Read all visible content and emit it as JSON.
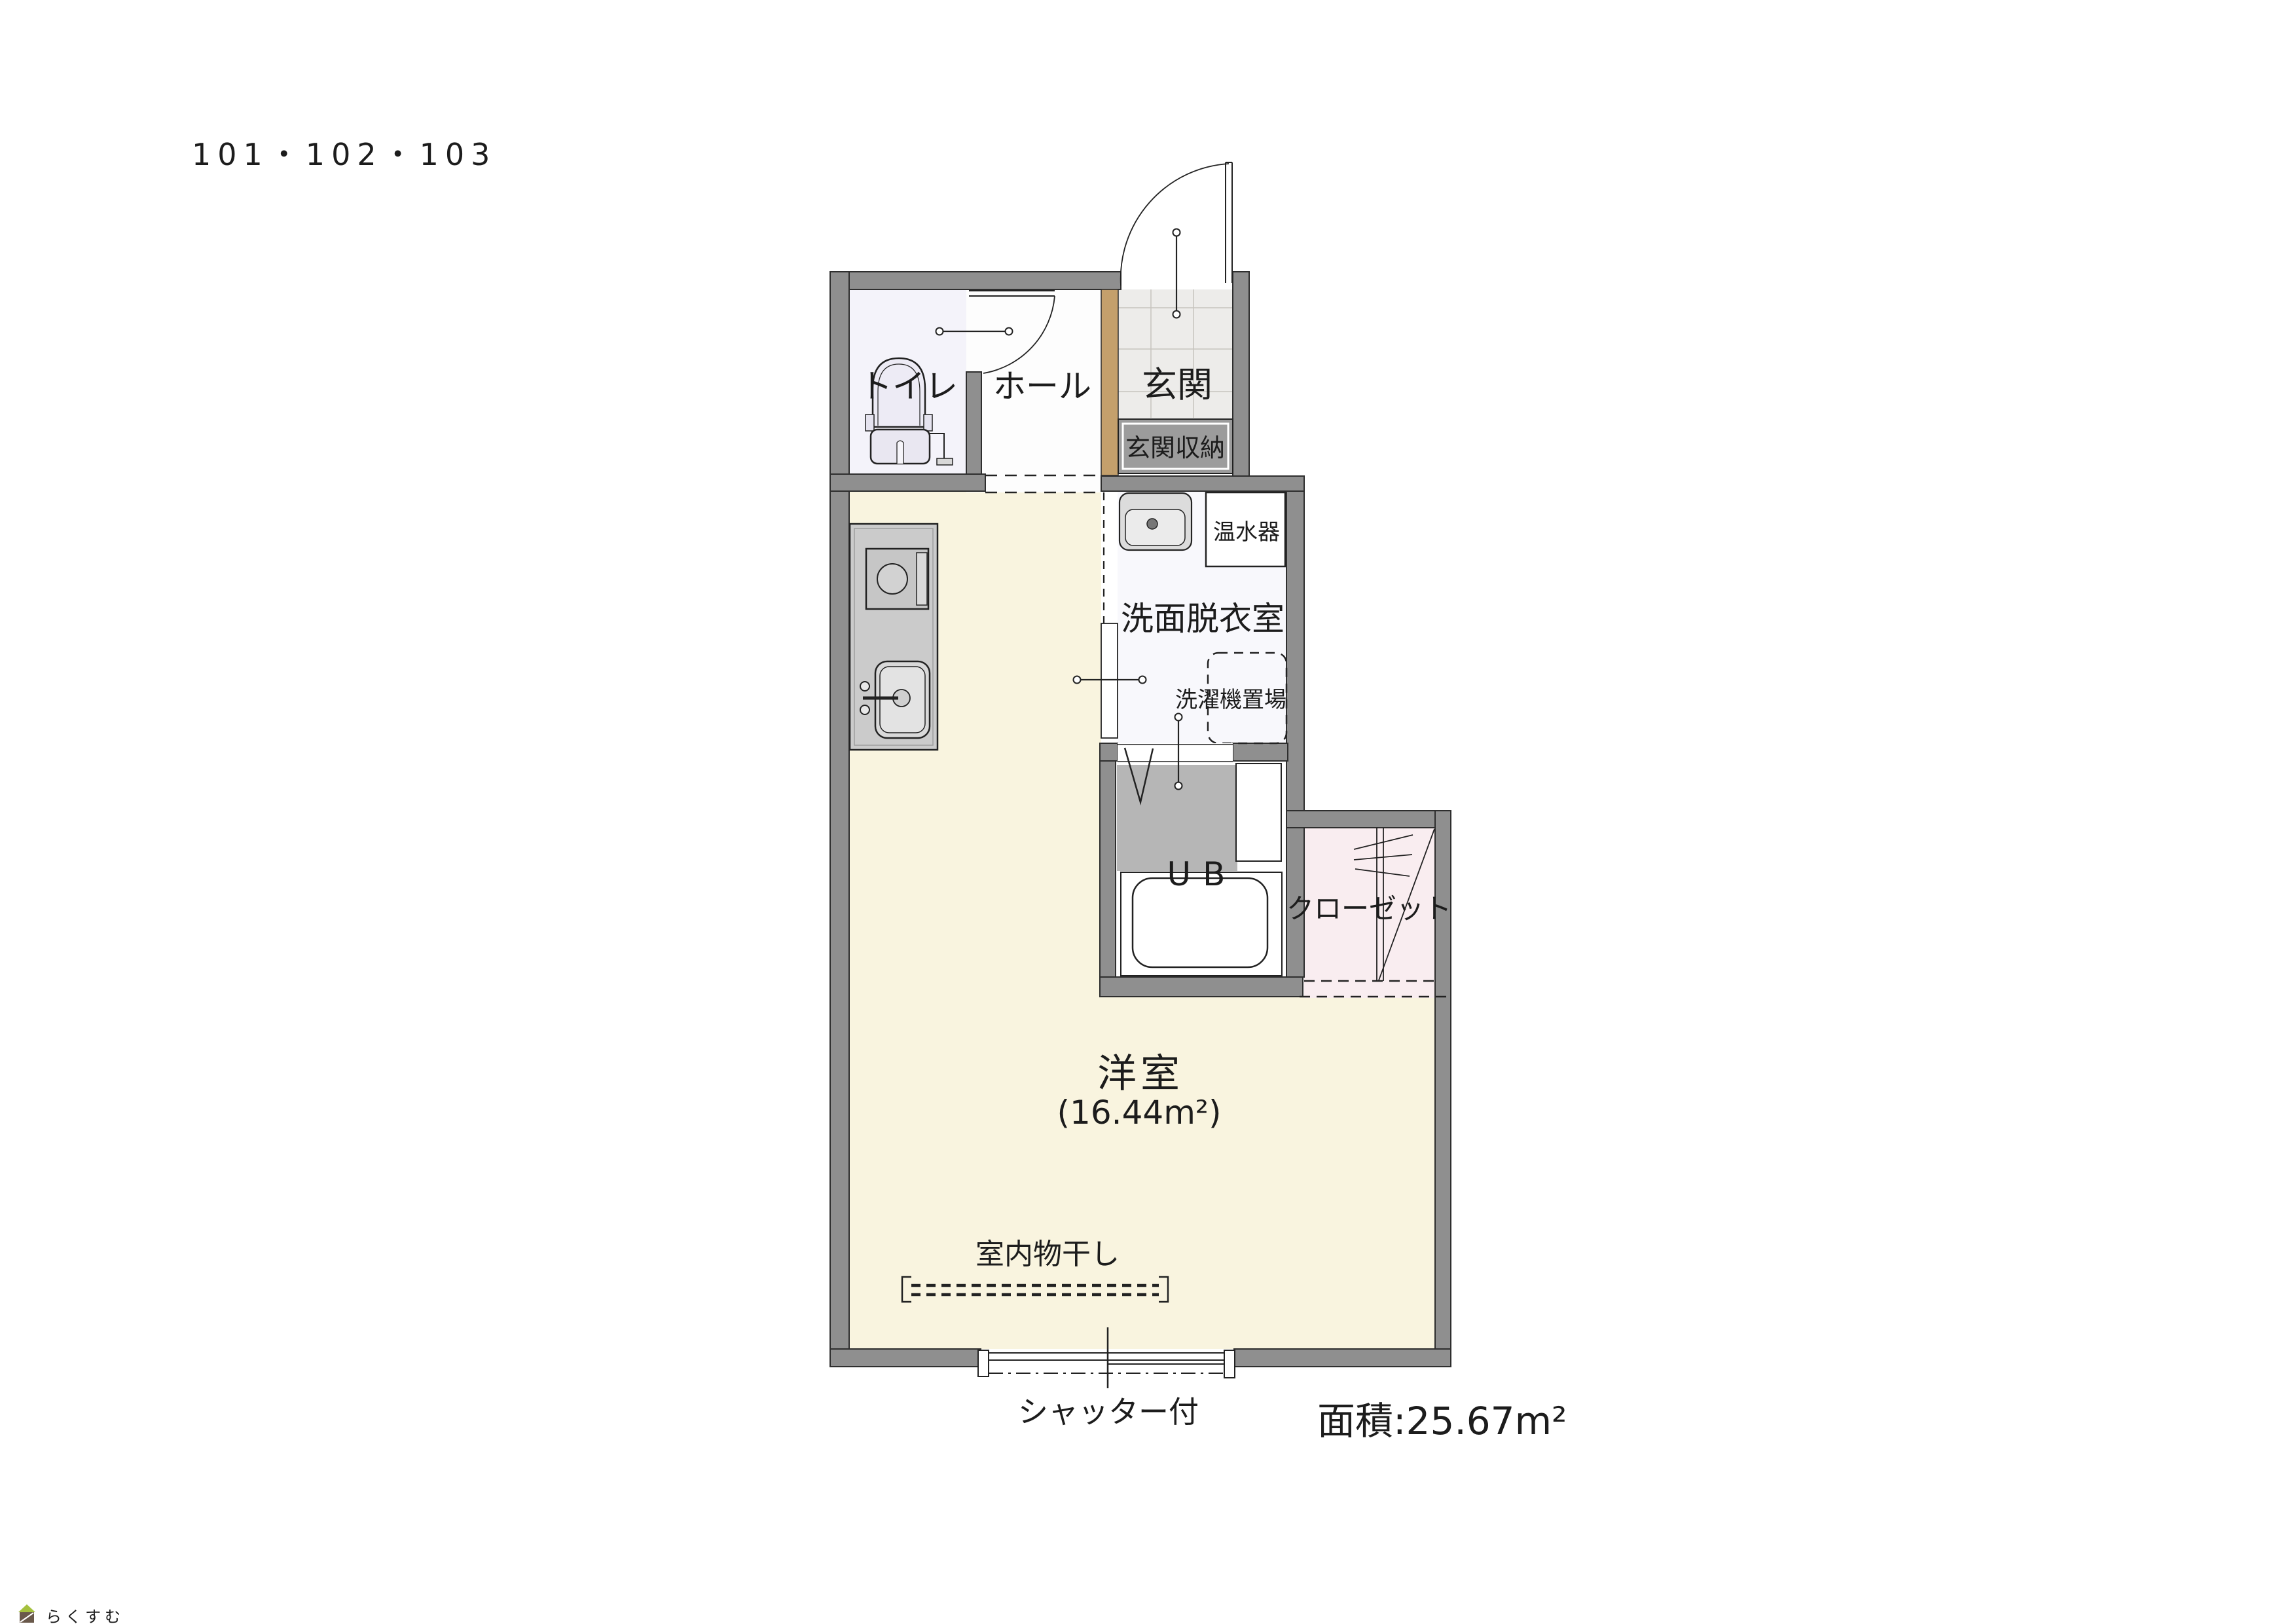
{
  "title": "101・102・103",
  "plan": {
    "rooms": {
      "toilet": {
        "label": "トイレ"
      },
      "hall": {
        "label": "ホール"
      },
      "entrance": {
        "label": "玄関"
      },
      "entrance_storage": {
        "label": "玄関収納"
      },
      "water_heater": {
        "label": "温水器"
      },
      "washroom": {
        "label": "洗面脱衣室"
      },
      "washer_space": {
        "label": "洗濯機置場"
      },
      "unit_bath": {
        "label": "UB"
      },
      "closet": {
        "label": "クローゼット"
      },
      "main_room": {
        "label": "洋室",
        "area_label": "(16.44m²)"
      }
    },
    "annotations": {
      "indoor_drying": "室内物干し",
      "shutter": "シャッター付",
      "total_area": "面積:25.67m²"
    },
    "palette": {
      "wall": "#8f8f8f",
      "wall_outline": "#2e2e2e",
      "line": "#222222",
      "main_room_floor": "#f9f4df",
      "toilet_floor": "#f4f3fa",
      "hall_floor": "#fdfdfd",
      "entrance_tile": "#edecea",
      "tile_line": "#c7c4be",
      "washroom_floor": "#f8f8fc",
      "ub_wet_floor": "#b6b6b6",
      "closet_floor": "#f9edf0",
      "entrance_divider": "#c4a06c",
      "storage_fill": "#9c9c9c",
      "kitchen_fill": "#cbcbcb",
      "fixture_fill": "#dcdcdc",
      "white": "#ffffff",
      "logo_green": "#a5c13e",
      "logo_brown": "#6a594b",
      "logo_text": "#8a7b6e",
      "title_text": "#3a3a3a"
    }
  },
  "logo": {
    "text": "らくすむ"
  }
}
